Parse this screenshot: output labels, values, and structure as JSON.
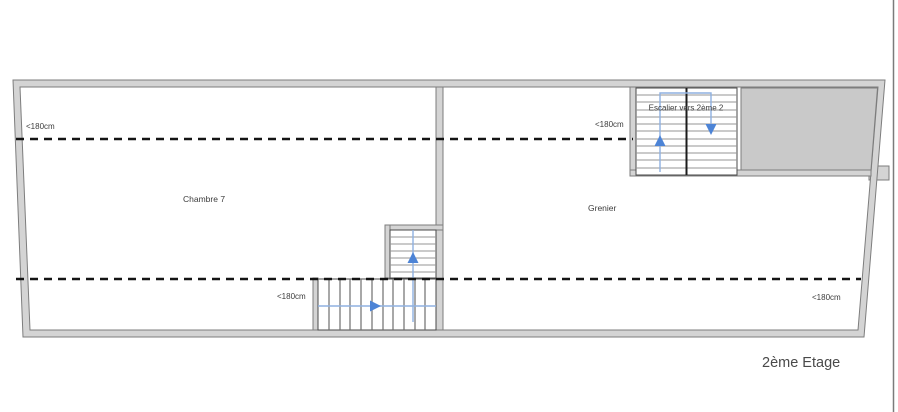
{
  "plan": {
    "floor_title": "2ème Etage",
    "rooms": [
      {
        "name": "Chambre 7"
      },
      {
        "name": "Grenier"
      }
    ],
    "stair_label": "Escalier vers 2ème 2",
    "annotations": [
      "<180cm",
      "<180cm",
      "<180cm",
      "<180cm"
    ]
  },
  "colors": {
    "wall-fill": "#d4d4d4",
    "wall-outline": "#7d7d7d",
    "stair-border": "#4a4a4a",
    "tread-line": "#949494",
    "dashed-line": "#141414",
    "guide-blue": "#8fb1e0",
    "arrow-blue": "#4d84d6",
    "zone-fill": "#c9c9c9",
    "text-color": "#3c3c3c"
  }
}
